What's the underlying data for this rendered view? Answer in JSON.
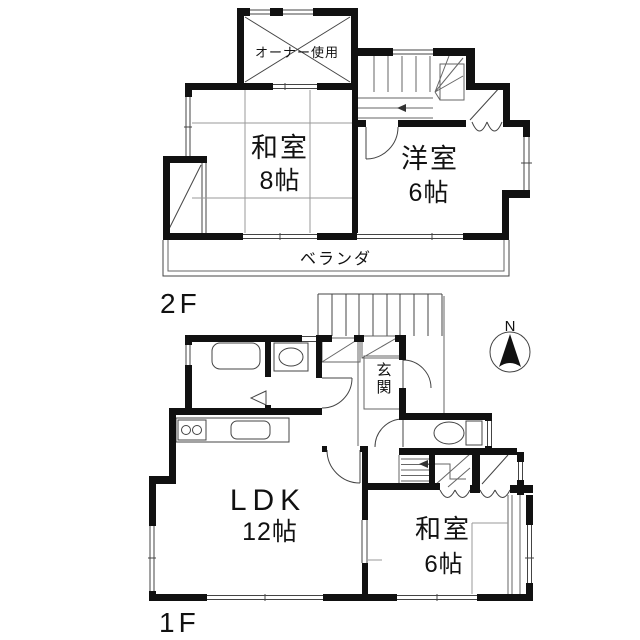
{
  "floor2": {
    "floor_label": "2F",
    "owner_room_label": "オーナー使用",
    "washitsu8": {
      "name": "和室",
      "size": "8帖"
    },
    "youshitsu6": {
      "name": "洋室",
      "size": "6帖"
    },
    "veranda_label": "ベランダ"
  },
  "floor1": {
    "floor_label": "1F",
    "ldk": {
      "name": "LDK",
      "size": "12帖"
    },
    "washitsu6": {
      "name": "和室",
      "size": "6帖"
    },
    "genkan_label": "玄関"
  },
  "compass": {
    "north_label": "N"
  },
  "colors": {
    "wall": "#111111",
    "thin_line": "#444444",
    "tatami_line": "#9a9a9a",
    "background": "#ffffff"
  }
}
